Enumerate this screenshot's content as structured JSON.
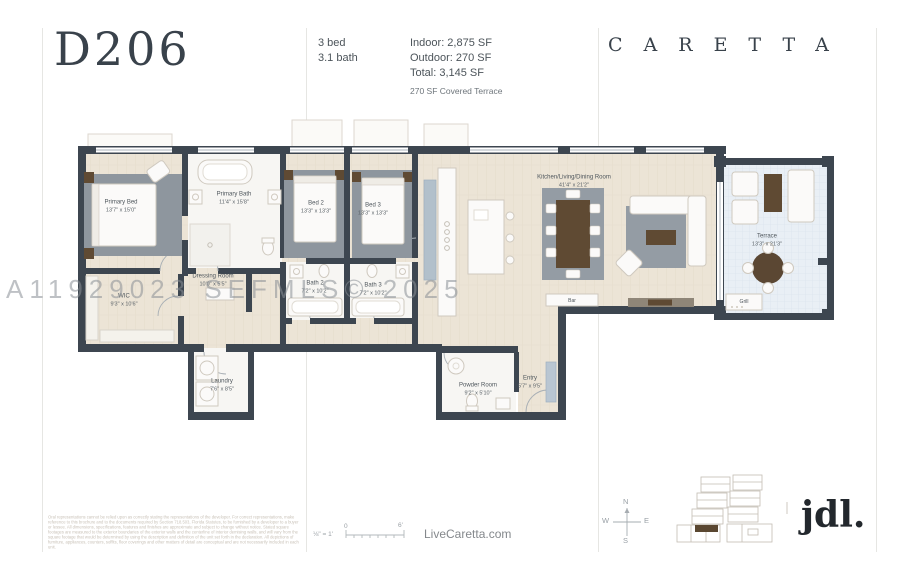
{
  "header": {
    "unit": "D206",
    "beds": "3 bed",
    "baths": "3.1 bath",
    "indoor": "Indoor: 2,875 SF",
    "outdoor": "Outdoor: 270 SF",
    "total": "Total: 3,145 SF",
    "terrace_note": "270 SF Covered Terrace",
    "brand": "CARETTA"
  },
  "watermark": "A11929023  SEFMLS© 2025",
  "rooms": [
    {
      "name": "Primary Bed",
      "dims": "13'7\" x 15'0\""
    },
    {
      "name": "Primary Bath",
      "dims": "11'4\" x 15'8\""
    },
    {
      "name": "WIC",
      "dims": "9'3\" x 10'6\""
    },
    {
      "name": "Dressing Room",
      "dims": "10'0\" x 5'5\""
    },
    {
      "name": "Bed 2",
      "dims": "13'3\" x 13'3\""
    },
    {
      "name": "Bed 3",
      "dims": "13'3\" x 13'3\""
    },
    {
      "name": "Bath 2",
      "dims": "7'2\" x 10'2\""
    },
    {
      "name": "Bath 3",
      "dims": "7'2\" x 10'2\""
    },
    {
      "name": "Kitchen/Living/Dining Room",
      "dims": "41'4\" x 21'2\""
    },
    {
      "name": "Terrace",
      "dims": "13'3\" x 21'3\""
    },
    {
      "name": "Laundry",
      "dims": "7'6\" x 8'5\""
    },
    {
      "name": "Powder Room",
      "dims": "9'2\" x 5'10\""
    },
    {
      "name": "Entry",
      "dims": "5'7\" x 9'5\""
    },
    {
      "name": "Bar"
    },
    {
      "name": "Grill"
    }
  ],
  "footer": {
    "disclaimer": "Oral representations cannot be relied upon as correctly stating the representations of the developer. For correct representations, make reference to this brochure and to the documents required by Section 718.503, Florida Statutes, to be furnished by a developer to a buyer or lessee. All dimensions, specifications, features and finishes are approximate and subject to change without notice. Stated square footages are measured to the exterior boundaries of the exterior walls and the centerline of interior demising walls, and will vary from the square footage that would be determined by using the description and definition of the unit set forth in the declaration. All depictions of furniture, appliances, counters, soffits, floor coverings and other matters of detail are conceptual and are not necessarily included in each unit.",
    "scale_label": "⅛\" = 1'",
    "scale_zero": "0",
    "scale_six": "6'",
    "website": "LiveCaretta.com",
    "compass": {
      "n": "N",
      "e": "E",
      "s": "S",
      "w": "W"
    },
    "logo": "jdl."
  },
  "colors": {
    "wall": "#3d4650",
    "floor_wood": "#ece4d6",
    "floor_tile": "#e9eff5",
    "accent_brown": "#5f4a33",
    "watermark_gray": "#8a9096"
  }
}
